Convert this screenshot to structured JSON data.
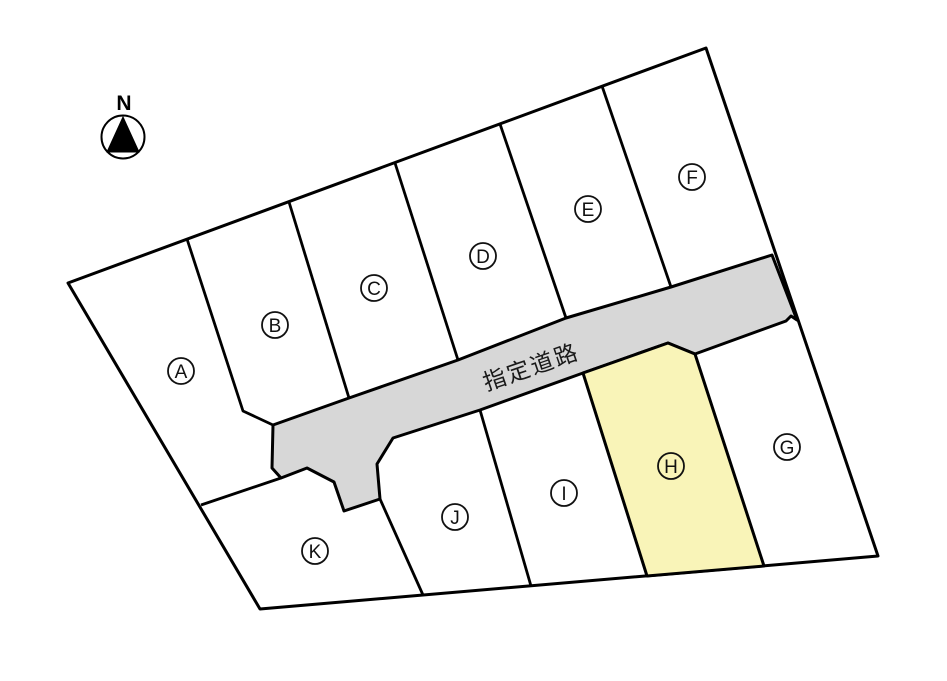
{
  "compass": {
    "label": "N"
  },
  "road": {
    "label": "指定道路",
    "fill": "#d7d7d7"
  },
  "site": {
    "outline_color": "#000000",
    "background": "#ffffff"
  },
  "highlight": {
    "lot_id": "H",
    "fill": "#f9f4b8"
  },
  "lots": [
    {
      "id": "A",
      "label": "A"
    },
    {
      "id": "B",
      "label": "B"
    },
    {
      "id": "C",
      "label": "C"
    },
    {
      "id": "D",
      "label": "D"
    },
    {
      "id": "E",
      "label": "E"
    },
    {
      "id": "F",
      "label": "F"
    },
    {
      "id": "G",
      "label": "G"
    },
    {
      "id": "H",
      "label": "H",
      "highlighted": true
    },
    {
      "id": "I",
      "label": "I"
    },
    {
      "id": "J",
      "label": "J"
    },
    {
      "id": "K",
      "label": "K"
    }
  ]
}
